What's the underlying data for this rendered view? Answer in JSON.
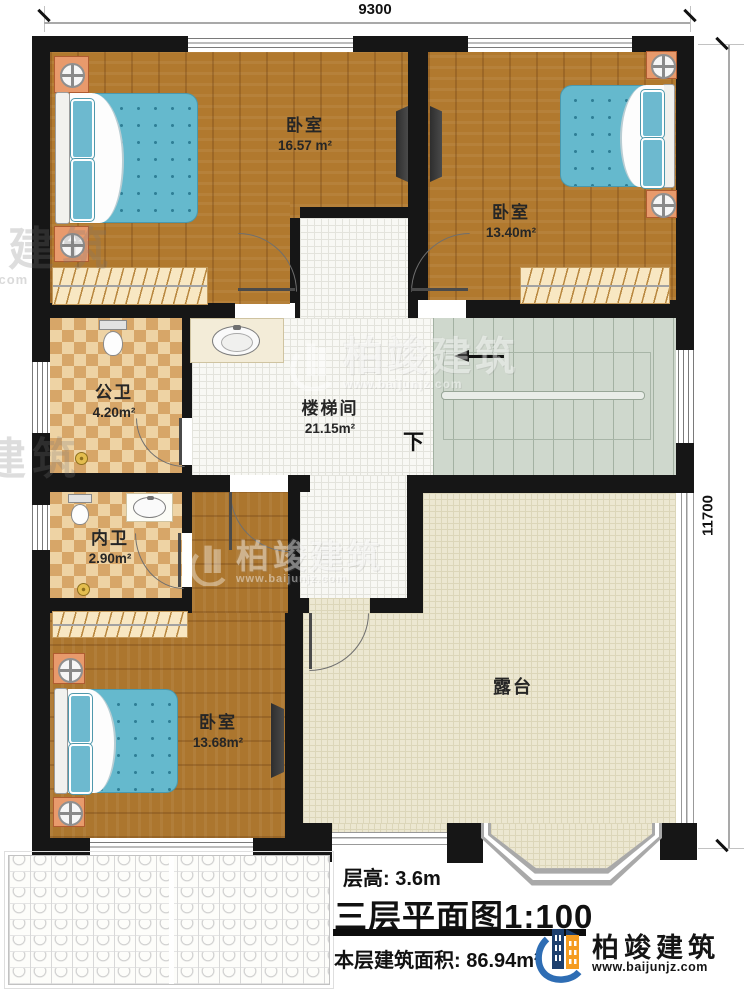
{
  "dimensions": {
    "top": "9300",
    "right": "11700"
  },
  "rooms": [
    {
      "name": "卧室",
      "area": "16.57 m²"
    },
    {
      "name": "卧室",
      "area": "13.40m²"
    },
    {
      "name": "公卫",
      "area": "4.20m²"
    },
    {
      "name": "楼梯间",
      "area": "21.15m²"
    },
    {
      "name": "内卫",
      "area": "2.90m²"
    },
    {
      "name": "卧室",
      "area": "13.68m²"
    },
    {
      "name": "露台",
      "area": ""
    }
  ],
  "stairs": {
    "down_label": "下"
  },
  "caption": {
    "floor_height": "层高: 3.6m",
    "title": "三层平面图",
    "scale": "1:100",
    "floor_area": "本层建筑面积: 86.94m²"
  },
  "logo": {
    "name": "柏竣建筑",
    "url": "www.baijunjz.com"
  },
  "watermark": {
    "text": "柏竣建筑",
    "url": "www.baijunjz.com"
  },
  "colors": {
    "wall": "#161616",
    "wood": "#b1792e",
    "mattress": "#65b9cd",
    "checker": "#d7a668",
    "terrace": "#ece7d1",
    "stairs": "#cfd8cd",
    "logo_navy": "#1d3f6e",
    "logo_orange": "#f59c20",
    "logo_blue": "#2e6db4"
  }
}
